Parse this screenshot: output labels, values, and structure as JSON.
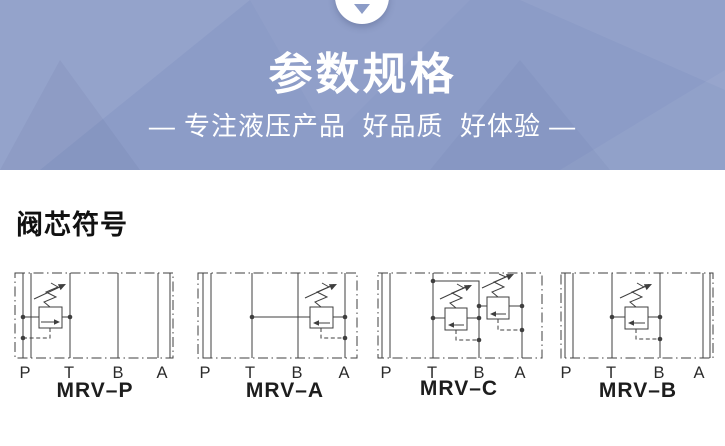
{
  "theme": {
    "header_bg": "#8c9cc7",
    "header_text": "#ffffff",
    "line_color": "#3f3f3f",
    "page_bg": "#ffffff",
    "heading_color": "#111111"
  },
  "header": {
    "arrow_icon": "chevron-down-icon",
    "title": "参数规格",
    "subtitle": "— 专注液压产品  好品质  好体验 —"
  },
  "section": {
    "heading": "阀芯符号"
  },
  "diagrams": [
    {
      "label": "MRV–P",
      "ports": [
        "P",
        "T",
        "B",
        "A"
      ]
    },
    {
      "label": "MRV–A",
      "ports": [
        "P",
        "T",
        "B",
        "A"
      ]
    },
    {
      "label": "MRV–C",
      "ports": [
        "P",
        "T",
        "B",
        "A"
      ]
    },
    {
      "label": "MRV–B",
      "ports": [
        "P",
        "T",
        "B",
        "A"
      ]
    }
  ]
}
